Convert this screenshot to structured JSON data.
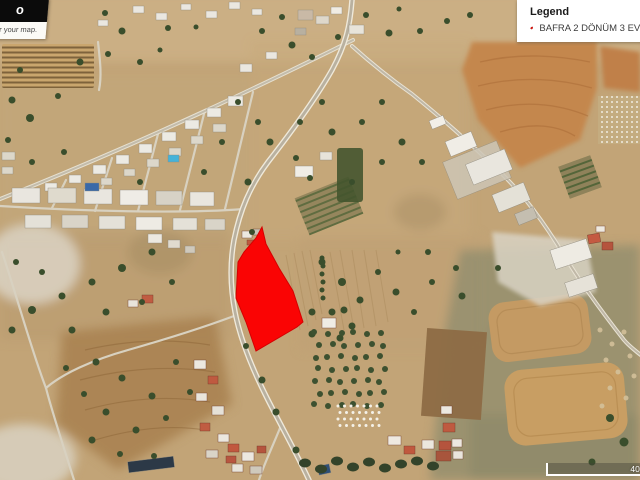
{
  "watermark": {
    "line1": "o",
    "line2": "r your map."
  },
  "legend": {
    "title": "Legend",
    "items": [
      {
        "label": "BAFRA 2 DÖNÜM 3 EVLEK Y",
        "marker_color": "#e8130c",
        "marker_outline": "#7a0b08"
      }
    ]
  },
  "scalebar": {
    "label": "400 m"
  },
  "parcel": {
    "color": "#fa0404",
    "points": "262,227 266,244 279,268 293,291 303,322 297,327 256,351 246,322 236,298 238,262 244,252 256,238"
  }
}
